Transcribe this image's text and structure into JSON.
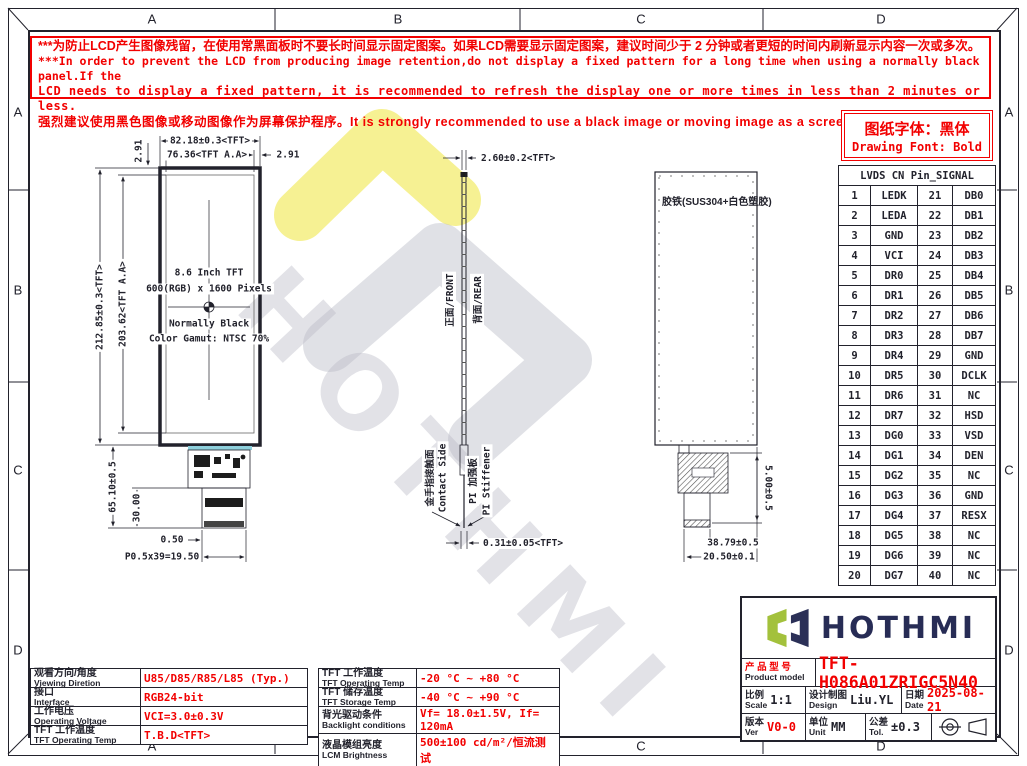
{
  "grid": {
    "cols": [
      "A",
      "B",
      "C",
      "D"
    ],
    "rows": [
      "A",
      "B",
      "C",
      "D"
    ]
  },
  "warning": {
    "line1": "***为防止LCD产生图像残留，在使用常黑面板时不要长时间显示固定图案。如果LCD需要显示固定图案，建议时间少于 2 分钟或者更短的时间内刷新显示内容一次或多次。",
    "line2": "***In order to prevent the LCD from producing image retention,do not display a fixed pattern for a long time when using a normally black panel.If the",
    "line3": "LCD needs to display a fixed pattern, it is recommended to refresh the display one or more times in less than 2 minutes or less.",
    "line4": "强烈建议使用黑色图像或移动图像作为屏幕保护程序。It is strongly recommended to use a black image or moving image as a screen saver."
  },
  "font_note": {
    "cn": "图纸字体：黑体",
    "en": "Drawing Font: Bold"
  },
  "pin_table": {
    "title": "LVDS CN Pin_SIGNAL",
    "rows": [
      [
        "1",
        "LEDK",
        "21",
        "DB0"
      ],
      [
        "2",
        "LEDA",
        "22",
        "DB1"
      ],
      [
        "3",
        "GND",
        "23",
        "DB2"
      ],
      [
        "4",
        "VCI",
        "24",
        "DB3"
      ],
      [
        "5",
        "DR0",
        "25",
        "DB4"
      ],
      [
        "6",
        "DR1",
        "26",
        "DB5"
      ],
      [
        "7",
        "DR2",
        "27",
        "DB6"
      ],
      [
        "8",
        "DR3",
        "28",
        "DB7"
      ],
      [
        "9",
        "DR4",
        "29",
        "GND"
      ],
      [
        "10",
        "DR5",
        "30",
        "DCLK"
      ],
      [
        "11",
        "DR6",
        "31",
        "NC"
      ],
      [
        "12",
        "DR7",
        "32",
        "HSD"
      ],
      [
        "13",
        "DG0",
        "33",
        "VSD"
      ],
      [
        "14",
        "DG1",
        "34",
        "DEN"
      ],
      [
        "15",
        "DG2",
        "35",
        "NC"
      ],
      [
        "16",
        "DG3",
        "36",
        "GND"
      ],
      [
        "17",
        "DG4",
        "37",
        "RESX"
      ],
      [
        "18",
        "DG5",
        "38",
        "NC"
      ],
      [
        "19",
        "DG6",
        "39",
        "NC"
      ],
      [
        "20",
        "DG7",
        "40",
        "NC"
      ]
    ]
  },
  "front_view": {
    "dim_width_tft": "82.18±0.3<TFT>",
    "dim_width_aa": "76.36<TFT A.A>",
    "dim_bezel_left": "2.91",
    "dim_bezel_right": "2.91",
    "dim_height_tft": "212.85±0.3<TFT>",
    "dim_height_aa": "203.62<TFT A.A>",
    "dim_fpc_len": "65.10±0.5",
    "dim_fpc_len2": "30.00",
    "dim_margin": "0.50",
    "dim_pitch": "P0.5x39=19.50",
    "center_lines": [
      "8.6 Inch TFT",
      "600(RGB) x 1600 Pixels",
      "Normally Black",
      "Color Gamut: NTSC 70%"
    ]
  },
  "side_view": {
    "dim_thickness": "2.60±0.2<TFT>",
    "label_front": "正面/FRONT",
    "label_rear": "背面/REAR",
    "label_contact_cn": "金手指接触面",
    "label_contact_en": "Contact Side",
    "label_stiffener_cn": "PI 加强板",
    "label_stiffener_en": "PI Stiffener",
    "dim_fpc_thickness": "0.31±0.05<TFT>"
  },
  "rear_view": {
    "label_material": "胶铁(SUS304+白色塑胶)",
    "dim_conn_h": "5.00±0.5",
    "dim_conn_w1": "38.79±0.5",
    "dim_conn_w2": "20.50±0.1"
  },
  "spec_left": {
    "rows": [
      {
        "cn": "观看方向/角度",
        "en": "Viewing Diretion",
        "value": "U85/D85/R85/L85 (Typ.)"
      },
      {
        "cn": "接口",
        "en": "Interface",
        "value": "RGB24-bit"
      },
      {
        "cn": "工作电压",
        "en": "Operating Voltage",
        "value": "VCI=3.0±0.3V"
      },
      {
        "cn": "TFT 工作温度",
        "en": "TFT Operating Temp",
        "value": "T.B.D<TFT>"
      }
    ]
  },
  "spec_mid": {
    "rows": [
      {
        "cn": "TFT 工作温度",
        "en": "TFT Operating Temp",
        "value": "-20 °C ~ +80 °C"
      },
      {
        "cn": "TFT 储存温度",
        "en": "TFT Storage Temp",
        "value": "-40 °C ~ +90 °C"
      },
      {
        "cn": "背光驱动条件",
        "en": "Backlight conditions",
        "value": "Vf= 18.0±1.5V, If= 120mA"
      },
      {
        "cn": "液晶模组亮度",
        "en": "LCM Brightness",
        "value": "500±100 cd/m²/恒流测试"
      }
    ]
  },
  "title_block": {
    "brand": "HOTHMI",
    "product_label_cn": "产 品 型 号",
    "product_label_en": "Product model",
    "model": "TFT-H086A01ZRIGC5N40",
    "scale_cn": "比例",
    "scale_en": "Scale",
    "scale_value": "1:1",
    "design_cn": "设计制图",
    "design_en": "Design",
    "design_value": "Liu.YL",
    "date_cn": "日期",
    "date_en": "Date",
    "date_value": "2025-08-21",
    "ver_cn": "版本",
    "ver_en": "Ver",
    "ver_value": "V0-0",
    "unit_cn": "单位",
    "unit_en": "Unit",
    "unit_value": "MM",
    "tol_cn": "公差",
    "tol_en": "Tol.",
    "tol_value": "±0.3"
  },
  "watermark": "HOTHMI",
  "colors": {
    "red": "#f20000",
    "line": "#22222c",
    "brand_green": "#a3c13c",
    "brand_navy": "#2b3057",
    "cyan": "#8ed0dc",
    "watermark_yellow": "#f3ec6a"
  }
}
